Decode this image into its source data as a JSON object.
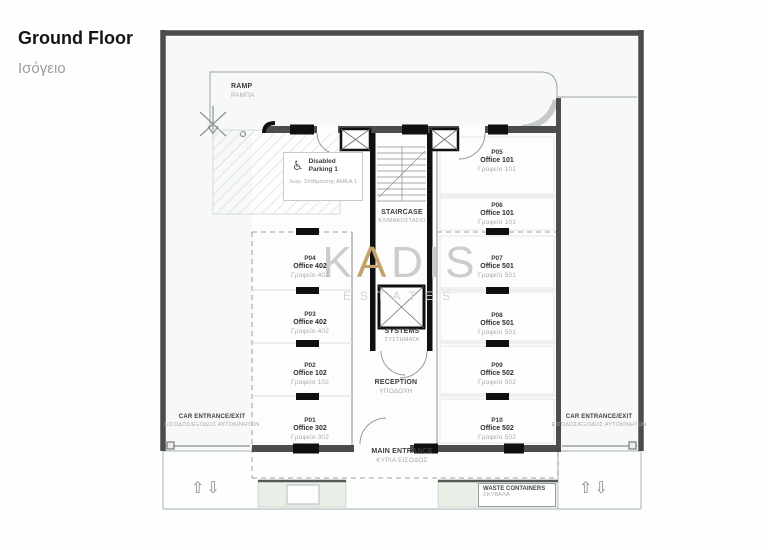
{
  "title": {
    "en": "Ground Floor",
    "el": "Ισόγειο"
  },
  "watermark": {
    "gray1": "K",
    "gold": "A",
    "gray2": "DIS",
    "subtitle": "ESTATES"
  },
  "labels": {
    "ramp": {
      "en": "RAMP",
      "el": "ΡΑΜΠΑ"
    },
    "disabled_parking": {
      "en": "Disabled Parking 1",
      "el": "Χώρ. Στάθμευσης ΑΜΕΑ 1"
    },
    "staircase": {
      "en": "STAIRCASE",
      "el": "ΚΛΙΜΑΚΟΣΤΑΣΙΟ"
    },
    "systems": {
      "en": "SYSTEMS",
      "el": "ΣΥΣΤΗΜΑΤΑ"
    },
    "reception": {
      "en": "RECEPTION",
      "el": "ΥΠΟΔΟΧΗ"
    },
    "main_entrance": {
      "en": "MAIN ENTRANCE",
      "el": "ΚΥΡΙΑ ΕΙΣΟΔΟΣ"
    },
    "car_entrance_left": {
      "en": "CAR ENTRANCE/EXIT",
      "el": "ΕΙΣΟΔΟΣ/ΕΞΟΔΟΣ ΑΥΤΟΚΙΝΗΤΩΝ"
    },
    "car_entrance_right": {
      "en": "CAR ENTRANCE/EXIT",
      "el": "ΕΙΣΟΔΟΣ/ΕΞΟΔΟΣ ΑΥΤΟΚΙΝΗΤΩΝ"
    },
    "waste": {
      "en": "WASTE CONTAINERS",
      "el": "ΣΚΥΒΑΛΑ"
    }
  },
  "icons": {
    "wheelchair": "♿",
    "arrow_up": "⇧",
    "arrow_down": "⇩"
  },
  "parking_spots": [
    {
      "id": "P01",
      "office": "Office 302",
      "el": "Γραφείο 302"
    },
    {
      "id": "P02",
      "office": "Office 102",
      "el": "Γραφείο 102"
    },
    {
      "id": "P03",
      "office": "Office 402",
      "el": "Γραφείο 402"
    },
    {
      "id": "P04",
      "office": "Office 402",
      "el": "Γραφείο 402"
    },
    {
      "id": "P05",
      "office": "Office 101",
      "el": "Γραφείο 101"
    },
    {
      "id": "P06",
      "office": "Office 101",
      "el": "Γραφείο 101"
    },
    {
      "id": "P07",
      "office": "Office 501",
      "el": "Γραφείο 501"
    },
    {
      "id": "P08",
      "office": "Office 501",
      "el": "Γραφείο 501"
    },
    {
      "id": "P09",
      "office": "Office 502",
      "el": "Γραφείο 502"
    },
    {
      "id": "P10",
      "office": "Office 502",
      "el": "Γραφείο 502"
    }
  ],
  "colors": {
    "outer_wall": "#4c4c4c",
    "black_wall": "#0f0f0f",
    "label_primary": "#3c3c3c",
    "label_secondary": "#a8aba9",
    "watermark_gray": "#cbcccb",
    "watermark_gold": "#c3a36a",
    "planting_green": "#e9efe7",
    "site_background": "#f7f9f8"
  }
}
